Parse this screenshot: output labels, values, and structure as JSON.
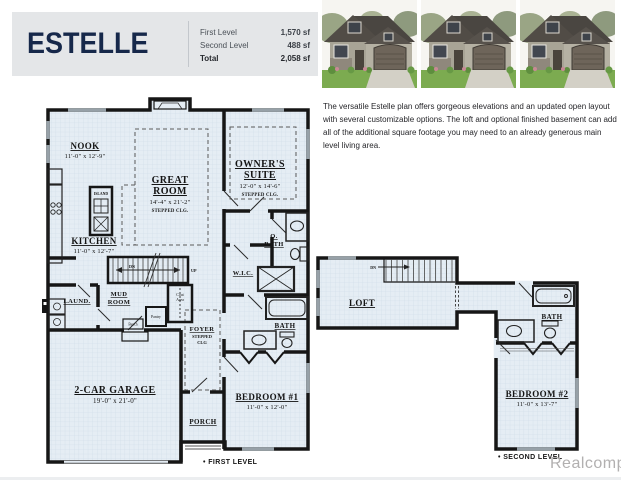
{
  "header": {
    "plan_name": "ESTELLE",
    "table": {
      "rows": [
        {
          "label": "First Level",
          "value": "1,570 sf"
        },
        {
          "label": "Second Level",
          "value": "488 sf"
        },
        {
          "label": "Total",
          "value": "2,058 sf"
        }
      ]
    }
  },
  "description": "The versatile Estelle plan offers gorgeous elevations and an updated open layout with several customizable options.  The loft and optional finished basement can add all of the additional square footage you may need to an already generous main level living area.",
  "first_level": {
    "bullet": "•",
    "caption": "FIRST LEVEL",
    "rooms": {
      "nook": {
        "name": "NOOK",
        "dims": "11'-0\" x 12'-9\""
      },
      "great_room": {
        "name_line1": "GREAT",
        "name_line2": "ROOM",
        "dims": "14'-4\" x 21'-2\"",
        "ceiling": "STEPPED CLG."
      },
      "owners_suite": {
        "name_line1": "OWNER'S",
        "name_line2": "SUITE",
        "dims": "12'-0\" x 14'-6\"",
        "ceiling": "STEPPED CLG."
      },
      "kitchen": {
        "name": "KITCHEN",
        "dims": "11'-0\" x 12'-7\""
      },
      "island": {
        "name": "ISLAND"
      },
      "owners_bath": {
        "name_line1": "O.",
        "name_line2": "BATH"
      },
      "wic": {
        "name": "W.I.C."
      },
      "laundry": {
        "name": "LAUND."
      },
      "mud_room": {
        "name_line1": "MUD",
        "name_line2": "ROOM"
      },
      "coat_area": {
        "name_line1": "Coat",
        "name_line2": "Area"
      },
      "bench": {
        "name": "Bench"
      },
      "pantry": {
        "name": "Pantry"
      },
      "foyer": {
        "name": "FOYER",
        "ceiling_line1": "STEPPED",
        "ceiling_line2": "CLG"
      },
      "bath": {
        "name": "BATH"
      },
      "bedroom1": {
        "name": "BEDROOM #1",
        "dims": "11'-0\" x 12'-0\""
      },
      "garage": {
        "name": "2-CAR GARAGE",
        "dims": "19'-0\" x 21'-0\""
      },
      "porch": {
        "name": "PORCH"
      },
      "stairs": {
        "up": "UP",
        "dn": "DN"
      }
    }
  },
  "second_level": {
    "bullet": "•",
    "caption": "SECOND LEVEL",
    "rooms": {
      "loft": {
        "name": "LOFT"
      },
      "bath": {
        "name": "BATH"
      },
      "bedroom2": {
        "name": "BEDROOM #2",
        "dims": "11'-0\" x 13'-7\""
      },
      "stairs": {
        "dn": "DN"
      }
    }
  },
  "watermark": "Realcomp",
  "colors": {
    "accent_navy": "#16284a",
    "header_bg": "#e4e6e8",
    "plan_bg": "#e5edf4",
    "grid_line": "#cbdae6",
    "wall": "#161616",
    "window_gray": "#97a1a8",
    "watermark_gray": "#b2b0b0"
  }
}
